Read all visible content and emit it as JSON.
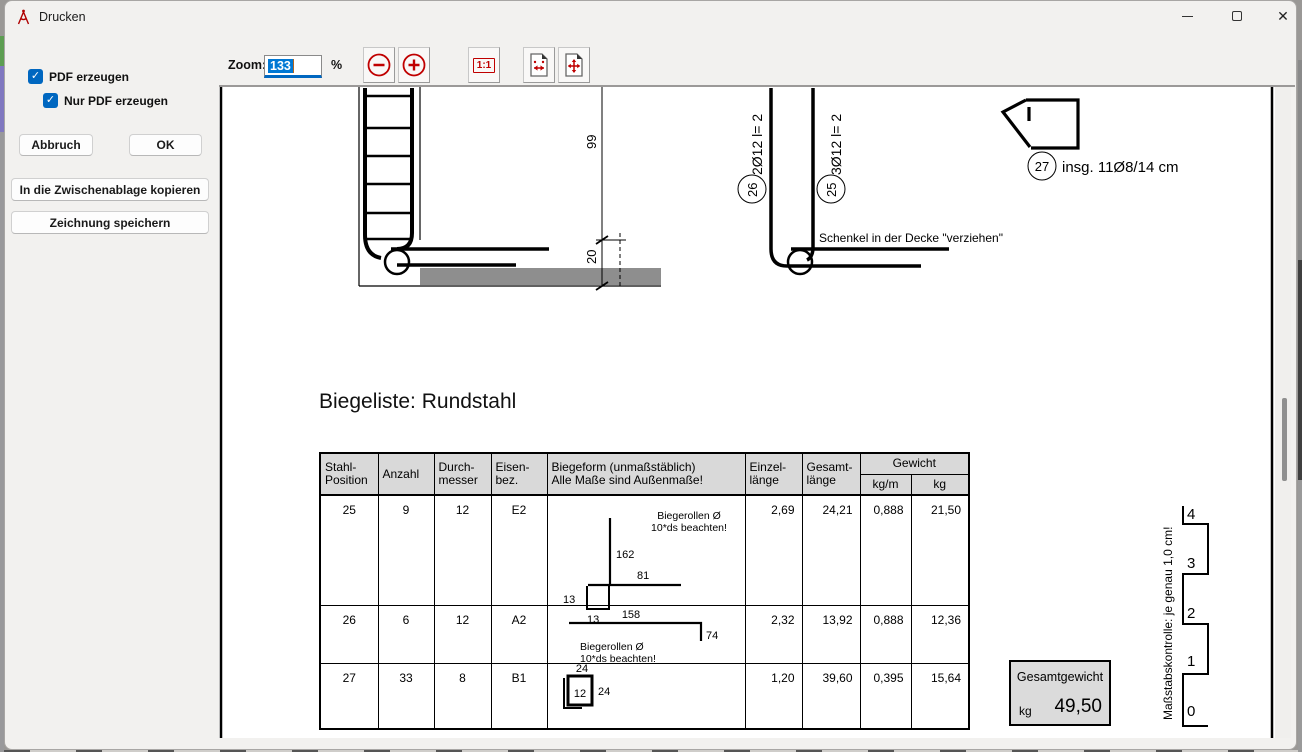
{
  "window": {
    "title": "Drucken"
  },
  "sidebar": {
    "checkbox_pdf": "PDF erzeugen",
    "checkbox_pdf_only": "Nur PDF erzeugen",
    "btn_abort": "Abbruch",
    "btn_ok": "OK",
    "btn_copy": "In die Zwischenablage kopieren",
    "btn_save": "Zeichnung speichern"
  },
  "toolbar": {
    "zoom_label": "Zoom:",
    "zoom_value": "133",
    "percent_label": "%",
    "one_to_one": "1:1"
  },
  "drawing": {
    "list_title": "Biegeliste: Rundstahl",
    "dim_wall_height": "99",
    "dim_slab": "20",
    "note_schenkel": "Schenkel in der Decke \"verziehen\"",
    "pos26": {
      "circle": "26",
      "label": "2Ø12  l= 2"
    },
    "pos25": {
      "circle": "25",
      "label": "3Ø12  l= 2"
    },
    "pos27": {
      "circle": "27",
      "label": "insg. 11Ø8/14 cm"
    }
  },
  "table": {
    "headers": {
      "col1a": "Stahl-",
      "col1b": "Position",
      "col2": "Anzahl",
      "col3a": "Durch-",
      "col3b": "messer",
      "col4a": "Eisen-",
      "col4b": "bez.",
      "col5a": "Biegeform (unmaßstäblich)",
      "col5b": "Alle Maße sind Außenmaße!",
      "col6a": "Einzel-",
      "col6b": "länge",
      "col7a": "Gesamt-",
      "col7b": "länge",
      "col8": "Gewicht",
      "col8a": "kg/m",
      "col8b": "kg"
    },
    "rows": [
      {
        "position": "25",
        "anzahl": "9",
        "durchmesser": "12",
        "eisenbez": "E2",
        "einzellaenge": "2,69",
        "gesamtlaenge": "24,21",
        "kg_m": "0,888",
        "kg": "21,50",
        "biegeform": {
          "note1": "Biegerollen Ø",
          "note2": "10*ds beachten!",
          "dim_v": "162",
          "dim_h": "81",
          "dim_hook_side": "13",
          "dim_hook_bottom": "13"
        }
      },
      {
        "position": "26",
        "anzahl": "6",
        "durchmesser": "12",
        "eisenbez": "A2",
        "einzellaenge": "2,32",
        "gesamtlaenge": "13,92",
        "kg_m": "0,888",
        "kg": "12,36",
        "biegeform": {
          "note1": "Biegerollen Ø",
          "note2": "10*ds beachten!",
          "dim_h": "158",
          "dim_v": "74"
        }
      },
      {
        "position": "27",
        "anzahl": "33",
        "durchmesser": "8",
        "eisenbez": "B1",
        "einzellaenge": "1,20",
        "gesamtlaenge": "39,60",
        "kg_m": "0,395",
        "kg": "15,64",
        "biegeform": {
          "dim_top": "24",
          "dim_inside": "12",
          "dim_right": "24"
        }
      }
    ]
  },
  "total": {
    "label": "Gesamtgewicht",
    "unit": "kg",
    "value": "49,50"
  },
  "scale_control": {
    "label": "Maßstabskontrolle: je genau 1,0 cm!",
    "ticks": [
      "4",
      "3",
      "2",
      "1",
      "0"
    ]
  }
}
